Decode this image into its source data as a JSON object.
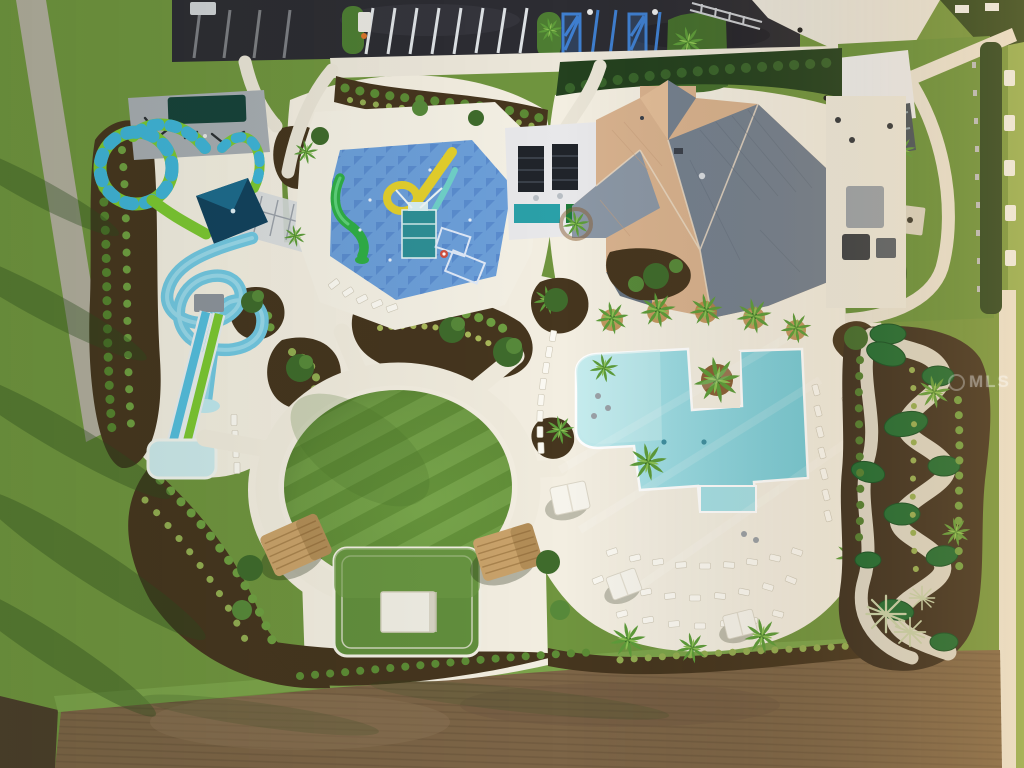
{
  "watermark": {
    "text": "MLS"
  },
  "palette": {
    "grass": "#70953f",
    "grass_bright": "#8fae53",
    "deck": "#f3eee1",
    "path": "#e9e4d6",
    "asphalt": "#2d2d33",
    "pool_water": "#8ad5de",
    "pool_shallow": "#c6ecee",
    "splash_pad": "#6c9fd9",
    "splash_pattern": "#4a7cc4",
    "slide_blue": "#72c8e2",
    "slide_green": "#7cc832",
    "canopy_teal": "#12425e",
    "roof_tan": "#d8b28e",
    "roof_slate": "#74808f",
    "golf_green": "#1b6a31",
    "mulch": "#46361f",
    "dirt_field": "#7d6547",
    "thatch": "#c9a26a",
    "handicap_blue": "#3f7fd0",
    "hedge": "#24411f"
  }
}
